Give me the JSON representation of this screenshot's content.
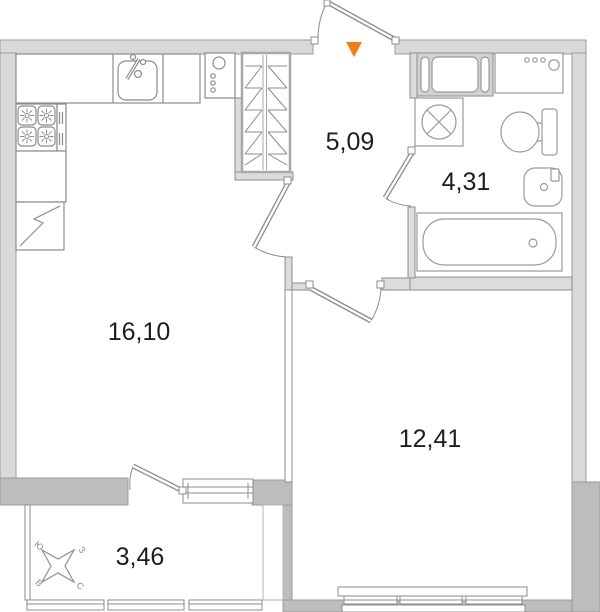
{
  "floor_plan": {
    "rooms": [
      {
        "name": "kitchen-living-room",
        "area_label": "16,10"
      },
      {
        "name": "hallway",
        "area_label": "5,09"
      },
      {
        "name": "bathroom",
        "area_label": "4,31"
      },
      {
        "name": "bedroom",
        "area_label": "12,41"
      },
      {
        "name": "balcony",
        "area_label": "3,46"
      }
    ],
    "compass": {
      "south_label": "Ю",
      "west_label": "З",
      "east_label": "В",
      "north_label": "С"
    },
    "entrance": {
      "marker_color": "#ee7d21"
    },
    "colors": {
      "wall_light": "#d9d9d9",
      "wall_dark": "#bdbdbd",
      "outline": "#8c8c8c",
      "text": "#1d1d1d"
    }
  }
}
